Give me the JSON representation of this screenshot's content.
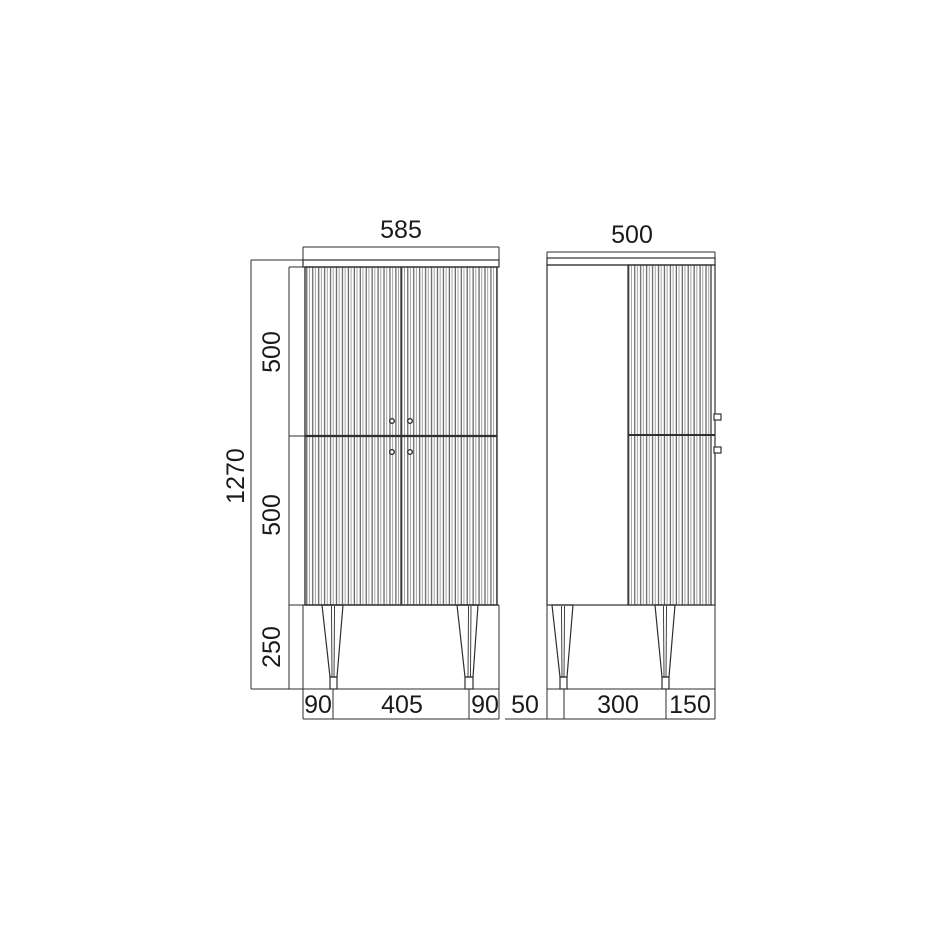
{
  "drawing": {
    "title": "cabinet-dimension-drawing",
    "front": {
      "width_label": "585",
      "total_height_label": "1270",
      "upper_section_label": "500",
      "lower_section_label": "500",
      "leg_section_label": "250",
      "bottom_left_label": "90",
      "bottom_center_label": "405",
      "bottom_right_label": "90"
    },
    "side": {
      "depth_label": "500",
      "bottom_left_label": "50",
      "bottom_center_label": "300",
      "bottom_right_label": "150"
    },
    "colors": {
      "background": "#ffffff",
      "line": "#2e2e2e",
      "flute_dark": "#4f4f4f",
      "flute_light": "#9c9c9c",
      "text": "#1a1a1a"
    }
  }
}
